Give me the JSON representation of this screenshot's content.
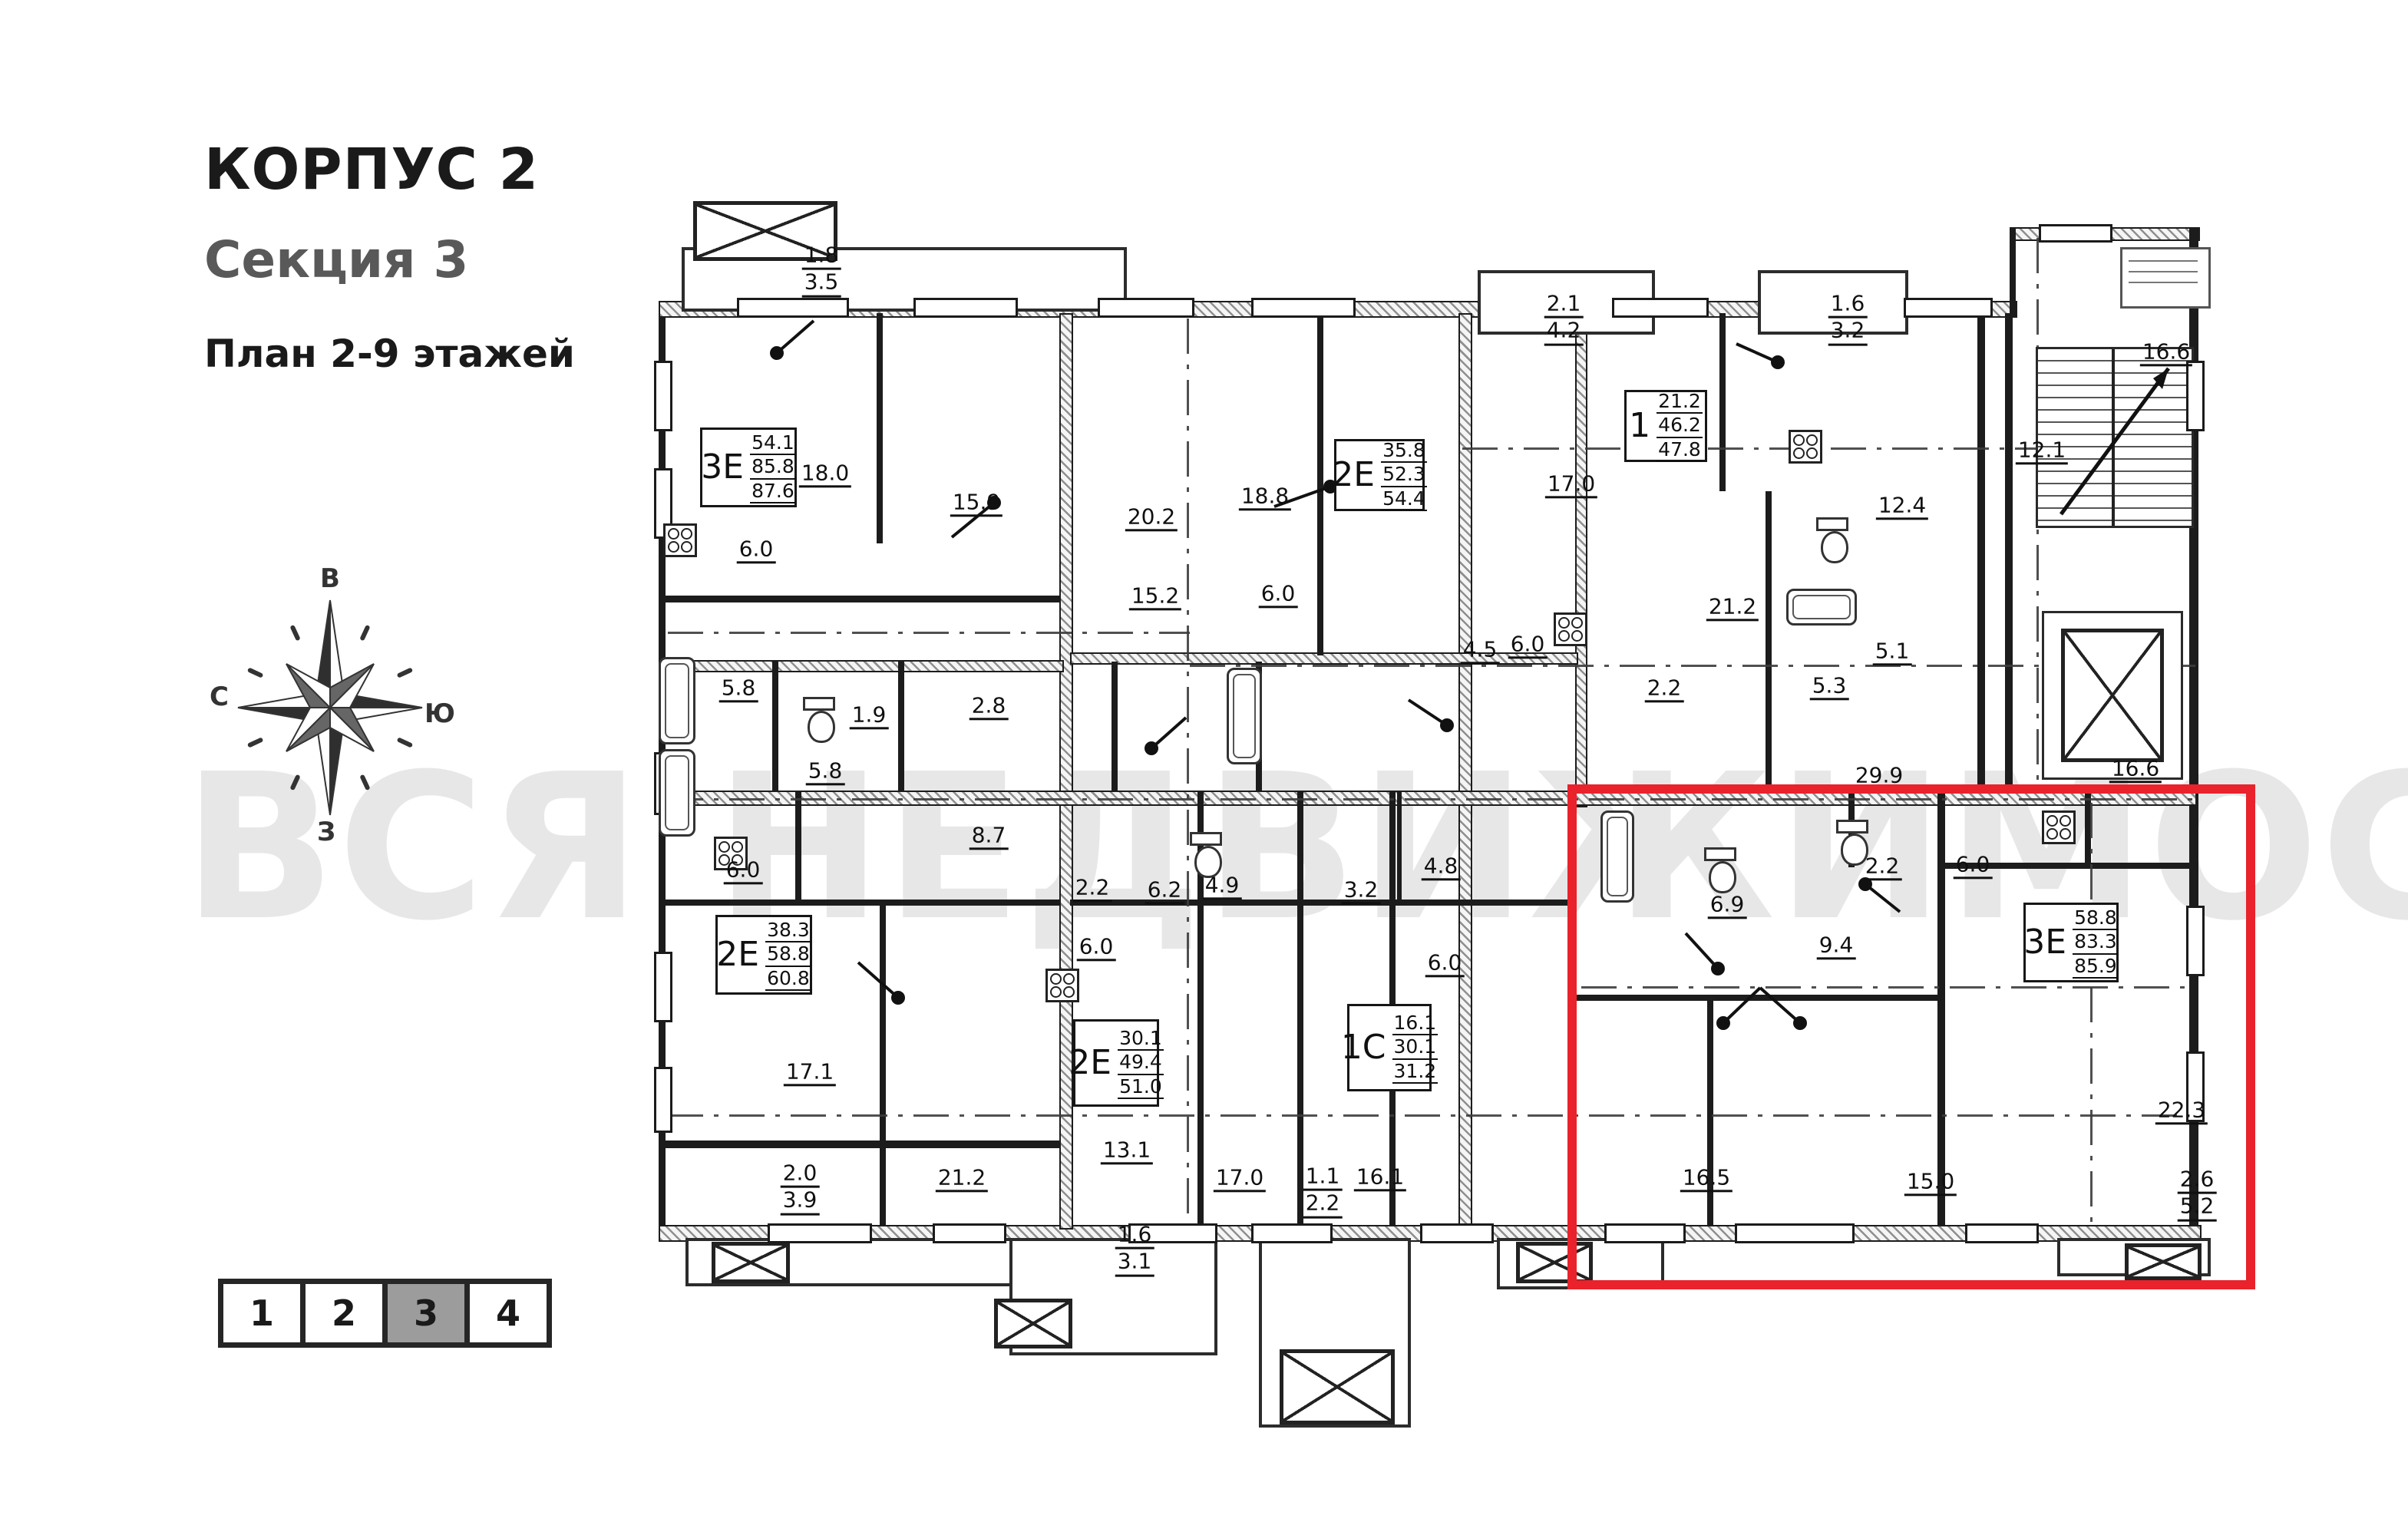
{
  "header": {
    "building": "КОРПУС 2",
    "section": "Секция 3",
    "plan": "План 2-9 этажей"
  },
  "compass": {
    "top": "В",
    "right": "Ю",
    "bottom": "З",
    "left": "С"
  },
  "watermark": "ВСЯ НЕДВИЖИМОСТЬ",
  "colors": {
    "highlight": "#e9222b",
    "section_active_bg": "#9c9c9c",
    "watermark": "#d5d5d5"
  },
  "section_selector": {
    "items": [
      {
        "label": "1",
        "active": false
      },
      {
        "label": "2",
        "active": false
      },
      {
        "label": "3",
        "active": true
      },
      {
        "label": "4",
        "active": false
      }
    ]
  },
  "apartments": [
    {
      "type": "3Е",
      "areas": [
        "54.1",
        "85.8",
        "87.6"
      ],
      "highlighted": false
    },
    {
      "type": "2Е",
      "areas": [
        "35.8",
        "52.3",
        "54.4"
      ],
      "highlighted": false
    },
    {
      "type": "1",
      "areas": [
        "21.2",
        "46.2",
        "47.8"
      ],
      "highlighted": false
    },
    {
      "type": "2Е",
      "areas": [
        "38.3",
        "58.8",
        "60.8"
      ],
      "highlighted": false
    },
    {
      "type": "2Е",
      "areas": [
        "30.1",
        "49.4",
        "51.0"
      ],
      "highlighted": false
    },
    {
      "type": "1С",
      "areas": [
        "16.1",
        "30.1",
        "31.2"
      ],
      "highlighted": false
    },
    {
      "type": "3Е",
      "areas": [
        "58.8",
        "83.3",
        "85.9"
      ],
      "highlighted": true
    }
  ],
  "room_labels": [
    {
      "v": "1.8",
      "v2": "3.5"
    },
    {
      "v": "18.0"
    },
    {
      "v": "15.9"
    },
    {
      "v": "6.0"
    },
    {
      "v": "20.2"
    },
    {
      "v": "18.8"
    },
    {
      "v": "2.1",
      "v2": "4.2"
    },
    {
      "v": "1.6",
      "v2": "3.2"
    },
    {
      "v": "16.6"
    },
    {
      "v": "12.4"
    },
    {
      "v": "17.0"
    },
    {
      "v": "21.2"
    },
    {
      "v": "5.1"
    },
    {
      "v": "5.3"
    },
    {
      "v": "12.1"
    },
    {
      "v": "5.8"
    },
    {
      "v": "1.9"
    },
    {
      "v": "2.8"
    },
    {
      "v": "15.2"
    },
    {
      "v": "6.0"
    },
    {
      "v": "4.5"
    },
    {
      "v": "6.0"
    },
    {
      "v": "2.2"
    },
    {
      "v": "5.8"
    },
    {
      "v": "8.7"
    },
    {
      "v": "6.0"
    },
    {
      "v": "2.2"
    },
    {
      "v": "6.2"
    },
    {
      "v": "4.9"
    },
    {
      "v": "3.2"
    },
    {
      "v": "4.8"
    },
    {
      "v": "6.0"
    },
    {
      "v": "6.0"
    },
    {
      "v": "29.9"
    },
    {
      "v": "16.6"
    },
    {
      "v": "6.9"
    },
    {
      "v": "2.2"
    },
    {
      "v": "6.0"
    },
    {
      "v": "9.4"
    },
    {
      "v": "17.1"
    },
    {
      "v": "2.0",
      "v2": "3.9"
    },
    {
      "v": "21.2"
    },
    {
      "v": "13.1"
    },
    {
      "v": "1.6",
      "v2": "3.1"
    },
    {
      "v": "17.0"
    },
    {
      "v": "1.1",
      "v2": "2.2"
    },
    {
      "v": "16.1"
    },
    {
      "v": "16.5"
    },
    {
      "v": "15.0"
    },
    {
      "v": "22.3"
    },
    {
      "v": "2.6",
      "v2": "5.2"
    }
  ]
}
